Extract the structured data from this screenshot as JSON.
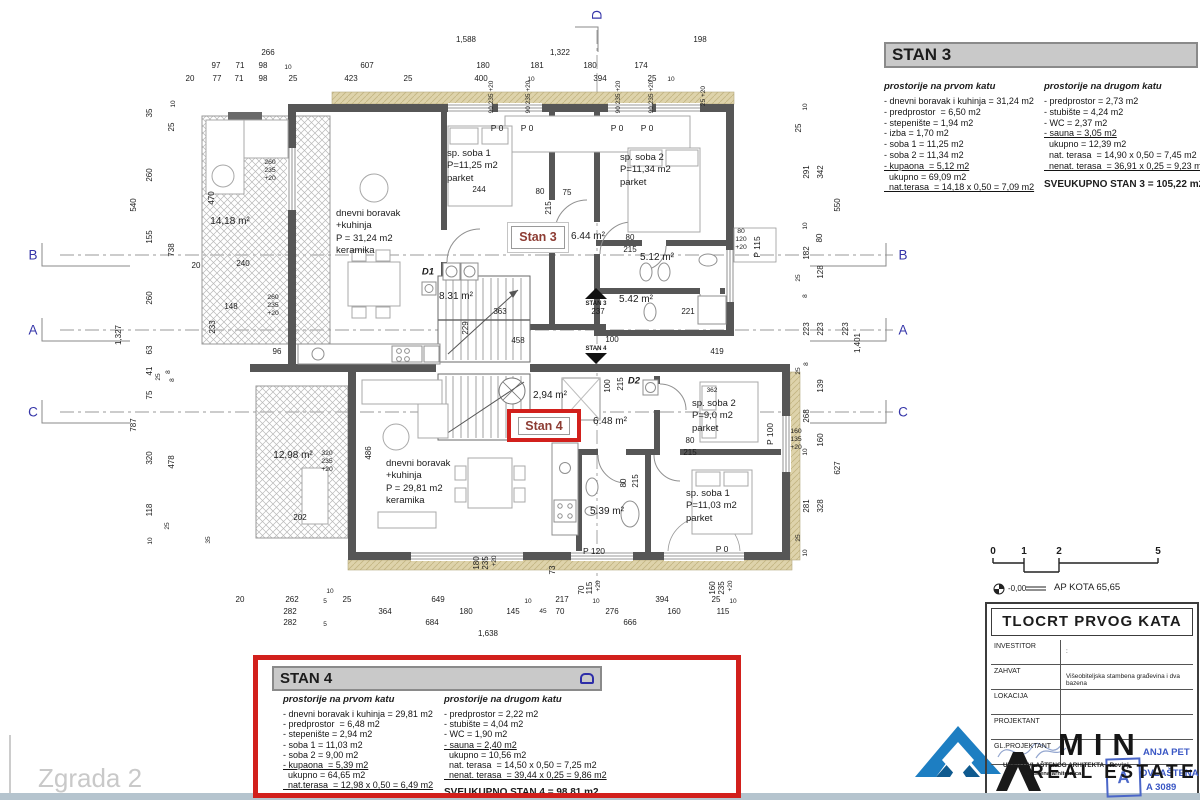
{
  "watermark": "Zgrada 2",
  "plan": {
    "stan3_tag": "Stan 3",
    "stan4_tag": "Stan 4"
  },
  "stan3": {
    "title": "STAN 3",
    "col1_header": "prostorije na prvom katu",
    "col2_header": "prostorije na drugom katu",
    "col1": [
      {
        "t": "- dnevni boravak i kuhinja = 31,24 m2"
      },
      {
        "t": "- predprostor  = 6,50 m2"
      },
      {
        "t": "- stepenište = 1,94 m2"
      },
      {
        "t": "- izba = 1,70 m2"
      },
      {
        "t": "- soba 1 = 11,25 m2"
      },
      {
        "t": "- soba 2 = 11,34 m2"
      },
      {
        "t": "- kupaona  = 5,12 m2",
        "u": 1
      },
      {
        "t": "  ukupno = 69,09 m2"
      },
      {
        "t": "  nat.terasa  = 14,18 x 0,50 = 7,09 m2",
        "u": 1
      }
    ],
    "col2": [
      {
        "t": "- predprostor = 2,73 m2"
      },
      {
        "t": "- stubište = 4,24 m2"
      },
      {
        "t": "- WC = 2,37 m2"
      },
      {
        "t": "- sauna = 3,05 m2",
        "u": 1
      },
      {
        "t": "  ukupno = 12,39 m2"
      },
      {
        "t": "  nat. terasa  = 14,90 x 0,50 = 7,45 m2"
      },
      {
        "t": "  nenat. terasa  = 36,91 x 0,25 = 9,23 m2",
        "u": 1
      }
    ],
    "total": "SVEUKUPNO STAN 3 = 105,22 m2"
  },
  "stan4": {
    "title": "STAN 4",
    "col1_header": "prostorije na prvom katu",
    "col2_header": "prostorije na drugom katu",
    "col1": [
      {
        "t": "- dnevni boravak i kuhinja = 29,81 m2"
      },
      {
        "t": "- predprostor  = 6,48 m2"
      },
      {
        "t": "- stepenište = 2,94 m2"
      },
      {
        "t": "- soba 1 = 11,03 m2"
      },
      {
        "t": "- soba 2 = 9,00 m2"
      },
      {
        "t": "- kupaona  = 5,39 m2",
        "u": 1
      },
      {
        "t": "  ukupno = 64,65 m2"
      },
      {
        "t": "  nat.terasa  = 12,98 x 0,50 = 6,49 m2",
        "u": 1
      }
    ],
    "col2": [
      {
        "t": "- predprostor = 2,22 m2"
      },
      {
        "t": "- stubište = 4,04 m2"
      },
      {
        "t": "- WC = 1,90 m2"
      },
      {
        "t": "- sauna = 2,40 m2",
        "u": 1
      },
      {
        "t": "  ukupno = 10,56 m2"
      },
      {
        "t": "  nat. terasa  = 14,50 x 0,50 = 7,25 m2"
      },
      {
        "t": "  nenat. terasa  = 39,44 x 0,25 = 9,86 m2",
        "u": 1
      }
    ],
    "total": "SVEUKUPNO STAN 4 = 98,81 m2"
  },
  "titleblock": {
    "title": "TLOCRT PRVOG KATA",
    "kota_value": "-0,00",
    "kota_label": "AP KOTA 65,65",
    "rows": [
      {
        "label": "INVESTITOR",
        "value": ":"
      },
      {
        "label": "ZAHVAT",
        "value": "Višeobiteljska stambena građevina i dva bazena"
      },
      {
        "label": "LOKACIJA",
        "value": ""
      },
      {
        "label": "PROJEKTANT",
        "value": ""
      },
      {
        "label": "GL.PROJEKTANT",
        "value": ""
      }
    ]
  },
  "stamp": {
    "office_line1": "URED OVLAŠTENOG ARHITEKTA - Rovinj",
    "office_line2": "Ovlaštena arhitektica",
    "name": "ANJA PET",
    "line2": "OVLAŠTENA",
    "line3": "A 3089",
    "seal_letter": "A"
  },
  "logo": {
    "min": "MIN",
    "real_estate": "REAL ESTATE"
  },
  "annotations": [
    {
      "t": "1,588",
      "x": 466,
      "y": 40
    },
    {
      "t": "198",
      "x": 700,
      "y": 40
    },
    {
      "t": "266",
      "x": 268,
      "y": 53
    },
    {
      "t": "1,322",
      "x": 560,
      "y": 53
    },
    {
      "t": "97",
      "x": 216,
      "y": 66
    },
    {
      "t": "71",
      "x": 240,
      "y": 66
    },
    {
      "t": "98",
      "x": 263,
      "y": 66
    },
    {
      "t": "10",
      "x": 288,
      "y": 68,
      "c": "tiny"
    },
    {
      "t": "607",
      "x": 367,
      "y": 66
    },
    {
      "t": "180",
      "x": 483,
      "y": 66
    },
    {
      "t": "181",
      "x": 537,
      "y": 66
    },
    {
      "t": "180",
      "x": 590,
      "y": 66
    },
    {
      "t": "174",
      "x": 641,
      "y": 66
    },
    {
      "t": "20",
      "x": 190,
      "y": 79
    },
    {
      "t": "77",
      "x": 217,
      "y": 79
    },
    {
      "t": "71",
      "x": 239,
      "y": 79
    },
    {
      "t": "98",
      "x": 263,
      "y": 79
    },
    {
      "t": "25",
      "x": 293,
      "y": 79
    },
    {
      "t": "423",
      "x": 351,
      "y": 79
    },
    {
      "t": "25",
      "x": 408,
      "y": 79
    },
    {
      "t": "400",
      "x": 481,
      "y": 79
    },
    {
      "t": "10",
      "x": 531,
      "y": 80,
      "c": "tiny"
    },
    {
      "t": "394",
      "x": 600,
      "y": 79
    },
    {
      "t": "25",
      "x": 652,
      "y": 79
    },
    {
      "t": "10",
      "x": 671,
      "y": 80,
      "c": "tiny"
    },
    {
      "t": "90 235 +20",
      "x": 492,
      "y": 97,
      "c": "dv tiny"
    },
    {
      "t": "90 235 +20",
      "x": 529,
      "y": 97,
      "c": "dv tiny"
    },
    {
      "t": "90 235 +20",
      "x": 619,
      "y": 97,
      "c": "dv tiny"
    },
    {
      "t": "90 235 +20",
      "x": 652,
      "y": 97,
      "c": "dv tiny"
    },
    {
      "t": "25 +20",
      "x": 704,
      "y": 96,
      "c": "dv tiny"
    },
    {
      "t": "35",
      "x": 150,
      "y": 113,
      "c": "dv"
    },
    {
      "t": "10",
      "x": 174,
      "y": 104,
      "c": "dv tiny"
    },
    {
      "t": "25",
      "x": 172,
      "y": 127,
      "c": "dv"
    },
    {
      "t": "260",
      "x": 150,
      "y": 175,
      "c": "dv"
    },
    {
      "t": "540",
      "x": 134,
      "y": 205,
      "c": "dv"
    },
    {
      "t": "470",
      "x": 212,
      "y": 198,
      "c": "dv"
    },
    {
      "t": "155",
      "x": 150,
      "y": 237,
      "c": "dv"
    },
    {
      "t": "738",
      "x": 172,
      "y": 250,
      "c": "dv"
    },
    {
      "t": "1,327",
      "x": 119,
      "y": 335,
      "c": "dv"
    },
    {
      "t": "260",
      "x": 150,
      "y": 298,
      "c": "dv"
    },
    {
      "t": "63",
      "x": 150,
      "y": 350,
      "c": "dv"
    },
    {
      "t": "41",
      "x": 150,
      "y": 371,
      "c": "dv"
    },
    {
      "t": "25",
      "x": 159,
      "y": 377,
      "c": "dv tiny"
    },
    {
      "t": "8",
      "x": 169,
      "y": 372,
      "c": "dv tiny"
    },
    {
      "t": "8",
      "x": 173,
      "y": 380,
      "c": "dv tiny"
    },
    {
      "t": "75",
      "x": 150,
      "y": 395,
      "c": "dv"
    },
    {
      "t": "787",
      "x": 134,
      "y": 425,
      "c": "dv"
    },
    {
      "t": "320",
      "x": 150,
      "y": 458,
      "c": "dv"
    },
    {
      "t": "478",
      "x": 172,
      "y": 462,
      "c": "dv"
    },
    {
      "t": "118",
      "x": 150,
      "y": 510,
      "c": "dv"
    },
    {
      "t": "25",
      "x": 168,
      "y": 526,
      "c": "dv tiny"
    },
    {
      "t": "10",
      "x": 151,
      "y": 541,
      "c": "dv tiny"
    },
    {
      "t": "233",
      "x": 213,
      "y": 327,
      "c": "dv"
    },
    {
      "t": "20",
      "x": 196,
      "y": 266
    },
    {
      "t": "240",
      "x": 243,
      "y": 264
    },
    {
      "t": "96",
      "x": 277,
      "y": 352
    },
    {
      "t": "148",
      "x": 231,
      "y": 307
    },
    {
      "t": "202",
      "x": 300,
      "y": 518
    },
    {
      "t": "35",
      "x": 209,
      "y": 540,
      "c": "dv tiny"
    },
    {
      "t": "260\n235\n+20",
      "x": 270,
      "y": 171,
      "c": "st"
    },
    {
      "t": "260\n235\n+20",
      "x": 273,
      "y": 306,
      "c": "st"
    },
    {
      "t": "320\n235\n+20",
      "x": 327,
      "y": 462,
      "c": "st"
    },
    {
      "t": "10",
      "x": 806,
      "y": 107,
      "c": "dv tiny"
    },
    {
      "t": "25",
      "x": 799,
      "y": 128,
      "c": "dv"
    },
    {
      "t": "291",
      "x": 807,
      "y": 172,
      "c": "dv"
    },
    {
      "t": "342",
      "x": 821,
      "y": 172,
      "c": "dv"
    },
    {
      "t": "550",
      "x": 838,
      "y": 205,
      "c": "dv"
    },
    {
      "t": "10",
      "x": 806,
      "y": 226,
      "c": "dv tiny"
    },
    {
      "t": "80",
      "x": 820,
      "y": 238,
      "c": "dv"
    },
    {
      "t": "182",
      "x": 807,
      "y": 253,
      "c": "dv"
    },
    {
      "t": "128",
      "x": 821,
      "y": 272,
      "c": "dv"
    },
    {
      "t": "25",
      "x": 799,
      "y": 278,
      "c": "dv tiny"
    },
    {
      "t": "8",
      "x": 806,
      "y": 296,
      "c": "dv tiny"
    },
    {
      "t": "223",
      "x": 807,
      "y": 329,
      "c": "dv"
    },
    {
      "t": "223",
      "x": 821,
      "y": 329,
      "c": "dv"
    },
    {
      "t": "223",
      "x": 846,
      "y": 329,
      "c": "dv"
    },
    {
      "t": "1,401",
      "x": 858,
      "y": 343,
      "c": "dv"
    },
    {
      "t": "8",
      "x": 807,
      "y": 364,
      "c": "dv tiny"
    },
    {
      "t": "25",
      "x": 799,
      "y": 371,
      "c": "dv tiny"
    },
    {
      "t": "139",
      "x": 821,
      "y": 386,
      "c": "dv"
    },
    {
      "t": "268",
      "x": 807,
      "y": 416,
      "c": "dv"
    },
    {
      "t": "160",
      "x": 821,
      "y": 440,
      "c": "dv"
    },
    {
      "t": "627",
      "x": 838,
      "y": 468,
      "c": "dv"
    },
    {
      "t": "10",
      "x": 806,
      "y": 452,
      "c": "dv tiny"
    },
    {
      "t": "281",
      "x": 807,
      "y": 506,
      "c": "dv"
    },
    {
      "t": "328",
      "x": 821,
      "y": 506,
      "c": "dv"
    },
    {
      "t": "25",
      "x": 799,
      "y": 538,
      "c": "dv tiny"
    },
    {
      "t": "10",
      "x": 806,
      "y": 553,
      "c": "dv tiny"
    },
    {
      "t": "160\n135\n+20",
      "x": 796,
      "y": 440,
      "c": "st"
    },
    {
      "t": "20",
      "x": 240,
      "y": 600
    },
    {
      "t": "262",
      "x": 292,
      "y": 600
    },
    {
      "t": "10",
      "x": 330,
      "y": 592,
      "c": "tiny"
    },
    {
      "t": "5",
      "x": 325,
      "y": 602,
      "c": "tiny"
    },
    {
      "t": "25",
      "x": 347,
      "y": 600
    },
    {
      "t": "649",
      "x": 438,
      "y": 600
    },
    {
      "t": "10",
      "x": 528,
      "y": 602,
      "c": "tiny"
    },
    {
      "t": "217",
      "x": 562,
      "y": 600
    },
    {
      "t": "10",
      "x": 596,
      "y": 602,
      "c": "tiny"
    },
    {
      "t": "394",
      "x": 662,
      "y": 600
    },
    {
      "t": "25",
      "x": 716,
      "y": 600
    },
    {
      "t": "10",
      "x": 733,
      "y": 602,
      "c": "tiny"
    },
    {
      "t": "282",
      "x": 290,
      "y": 612
    },
    {
      "t": "364",
      "x": 385,
      "y": 612
    },
    {
      "t": "180",
      "x": 466,
      "y": 612
    },
    {
      "t": "145",
      "x": 513,
      "y": 612
    },
    {
      "t": "45",
      "x": 543,
      "y": 612,
      "c": "tiny"
    },
    {
      "t": "70",
      "x": 560,
      "y": 612
    },
    {
      "t": "276",
      "x": 612,
      "y": 612
    },
    {
      "t": "160",
      "x": 674,
      "y": 612
    },
    {
      "t": "115",
      "x": 723,
      "y": 612
    },
    {
      "t": "282",
      "x": 290,
      "y": 623
    },
    {
      "t": "5",
      "x": 325,
      "y": 625,
      "c": "tiny"
    },
    {
      "t": "684",
      "x": 432,
      "y": 623
    },
    {
      "t": "666",
      "x": 630,
      "y": 623
    },
    {
      "t": "1,638",
      "x": 488,
      "y": 634
    },
    {
      "t": "180",
      "x": 477,
      "y": 563,
      "c": "dv"
    },
    {
      "t": "235",
      "x": 486,
      "y": 563,
      "c": "dv"
    },
    {
      "t": "+20",
      "x": 495,
      "y": 561,
      "c": "dv tiny"
    },
    {
      "t": "73",
      "x": 553,
      "y": 570,
      "c": "dv"
    },
    {
      "t": "70",
      "x": 582,
      "y": 590,
      "c": "dv"
    },
    {
      "t": "115",
      "x": 590,
      "y": 588,
      "c": "dv"
    },
    {
      "t": "+20",
      "x": 599,
      "y": 586,
      "c": "dv tiny"
    },
    {
      "t": "160",
      "x": 713,
      "y": 588,
      "c": "dv"
    },
    {
      "t": "235",
      "x": 722,
      "y": 588,
      "c": "dv"
    },
    {
      "t": "+20",
      "x": 731,
      "y": 586,
      "c": "dv tiny"
    },
    {
      "t": "244",
      "x": 479,
      "y": 190
    },
    {
      "t": "75",
      "x": 567,
      "y": 193
    },
    {
      "t": "80",
      "x": 540,
      "y": 192
    },
    {
      "t": "215",
      "x": 549,
      "y": 208,
      "c": "dv"
    },
    {
      "t": "80",
      "x": 630,
      "y": 238
    },
    {
      "t": "215",
      "x": 630,
      "y": 250
    },
    {
      "t": "363",
      "x": 500,
      "y": 312
    },
    {
      "t": "458",
      "x": 518,
      "y": 341
    },
    {
      "t": "229",
      "x": 466,
      "y": 328,
      "c": "dv"
    },
    {
      "t": "237",
      "x": 598,
      "y": 312
    },
    {
      "t": "100",
      "x": 612,
      "y": 340
    },
    {
      "t": "419",
      "x": 717,
      "y": 352
    },
    {
      "t": "221",
      "x": 688,
      "y": 312
    },
    {
      "t": "100",
      "x": 608,
      "y": 386,
      "c": "dv"
    },
    {
      "t": "215",
      "x": 621,
      "y": 384,
      "c": "dv"
    },
    {
      "t": "362",
      "x": 712,
      "y": 391,
      "c": "tiny"
    },
    {
      "t": "80",
      "x": 690,
      "y": 441
    },
    {
      "t": "215",
      "x": 690,
      "y": 453
    },
    {
      "t": "80",
      "x": 624,
      "y": 483,
      "c": "dv"
    },
    {
      "t": "215",
      "x": 636,
      "y": 481,
      "c": "dv"
    },
    {
      "t": "486",
      "x": 369,
      "y": 453,
      "c": "dv"
    },
    {
      "t": "D1",
      "x": 428,
      "y": 272,
      "c": "dl"
    },
    {
      "t": "D2",
      "x": 634,
      "y": 381,
      "c": "dl"
    },
    {
      "t": "P 0",
      "x": 497,
      "y": 128,
      "c": "pw"
    },
    {
      "t": "P 0",
      "x": 527,
      "y": 128,
      "c": "pw"
    },
    {
      "t": "P 0",
      "x": 617,
      "y": 128,
      "c": "pw"
    },
    {
      "t": "P 0",
      "x": 647,
      "y": 128,
      "c": "pw"
    },
    {
      "t": "P 115",
      "x": 757,
      "y": 247,
      "c": "pwv"
    },
    {
      "t": "80\n120\n+20",
      "x": 741,
      "y": 240,
      "c": "st"
    },
    {
      "t": "P 100",
      "x": 770,
      "y": 434,
      "c": "pwv"
    },
    {
      "t": "P 120",
      "x": 594,
      "y": 551,
      "c": "pw"
    },
    {
      "t": "P 0",
      "x": 722,
      "y": 549,
      "c": "pw"
    },
    {
      "t": "14,18 m²",
      "x": 230,
      "y": 222,
      "c": "ar"
    },
    {
      "t": "dnevni boravak\n+kuhinja\nP = 31,24 m2\nkeramika",
      "x": 336,
      "y": 208,
      "c": "rm"
    },
    {
      "t": "sp. soba 1\nP=11,25 m2\nparket",
      "x": 447,
      "y": 148,
      "c": "rm"
    },
    {
      "t": "sp. soba 2\nP=11,34 m2\nparket",
      "x": 620,
      "y": 152,
      "c": "rm"
    },
    {
      "t": "6.44 m²",
      "x": 588,
      "y": 237,
      "c": "ar"
    },
    {
      "t": "5.12 m²",
      "x": 657,
      "y": 258,
      "c": "ar"
    },
    {
      "t": "8.31 m²",
      "x": 456,
      "y": 297,
      "c": "ar"
    },
    {
      "t": "5.42 m²",
      "x": 636,
      "y": 300,
      "c": "ar"
    },
    {
      "t": "2,94 m²",
      "x": 550,
      "y": 396,
      "c": "ar"
    },
    {
      "t": "6.48 m²",
      "x": 610,
      "y": 422,
      "c": "ar"
    },
    {
      "t": "sp. soba 2\nP=9,0 m2\nparket",
      "x": 692,
      "y": 398,
      "c": "rm"
    },
    {
      "t": "sp. soba 1\nP=11,03 m2\nparket",
      "x": 686,
      "y": 488,
      "c": "rm"
    },
    {
      "t": "5.39 m²",
      "x": 607,
      "y": 512,
      "c": "ar"
    },
    {
      "t": "12,98 m²",
      "x": 293,
      "y": 456,
      "c": "ar"
    },
    {
      "t": "dnevni boravak\n+kuhinja\nP = 29,81 m2\nkeramika",
      "x": 386,
      "y": 458,
      "c": "rm"
    },
    {
      "t": "STAN 3",
      "x": 596,
      "y": 304,
      "c": "mk"
    },
    {
      "t": "STAN 4",
      "x": 596,
      "y": 349,
      "c": "mk"
    },
    {
      "t": "B",
      "x": 33,
      "y": 255,
      "c": "gl"
    },
    {
      "t": "A",
      "x": 33,
      "y": 330,
      "c": "gl"
    },
    {
      "t": "C",
      "x": 33,
      "y": 412,
      "c": "gl"
    },
    {
      "t": "B",
      "x": 903,
      "y": 255,
      "c": "gl"
    },
    {
      "t": "A",
      "x": 903,
      "y": 330,
      "c": "gl"
    },
    {
      "t": "C",
      "x": 903,
      "y": 412,
      "c": "gl"
    },
    {
      "t": "D",
      "x": 597,
      "y": 15,
      "c": "gl dv"
    },
    {
      "t": "0",
      "x": 993,
      "y": 552,
      "c": "sc"
    },
    {
      "t": "1",
      "x": 1024,
      "y": 552,
      "c": "sc"
    },
    {
      "t": "2",
      "x": 1059,
      "y": 552,
      "c": "sc"
    },
    {
      "t": "5",
      "x": 1158,
      "y": 552,
      "c": "sc"
    }
  ]
}
